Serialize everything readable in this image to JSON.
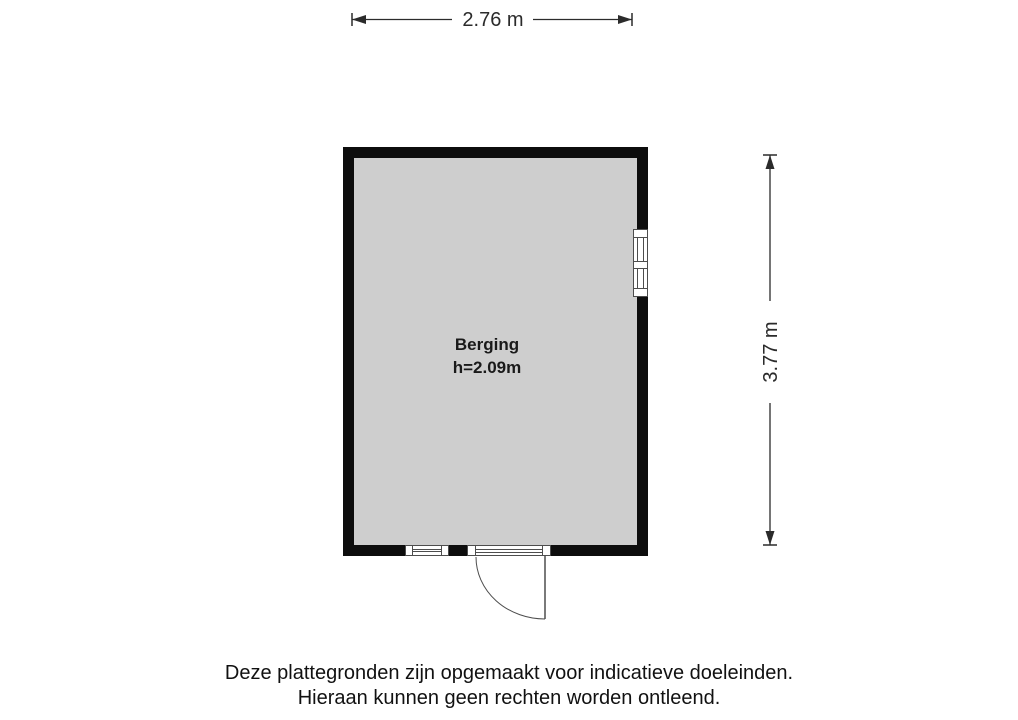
{
  "dimensions": {
    "width_label": "2.76 m",
    "height_label": "3.77 m"
  },
  "room": {
    "name": "Berging",
    "ceiling_height_label": "h=2.09m"
  },
  "disclaimer": {
    "line1": "Deze plattegronden zijn opgemaakt voor indicatieve doeleinden.",
    "line2": "Hieraan kunnen geen rechten worden ontleend."
  },
  "colors": {
    "wall": "#0d0d0d",
    "floor": "#cecece",
    "frame": "#4d4d4d",
    "dimension": "#2b2b2b",
    "text": "#1a1a1a",
    "background": "#ffffff"
  }
}
